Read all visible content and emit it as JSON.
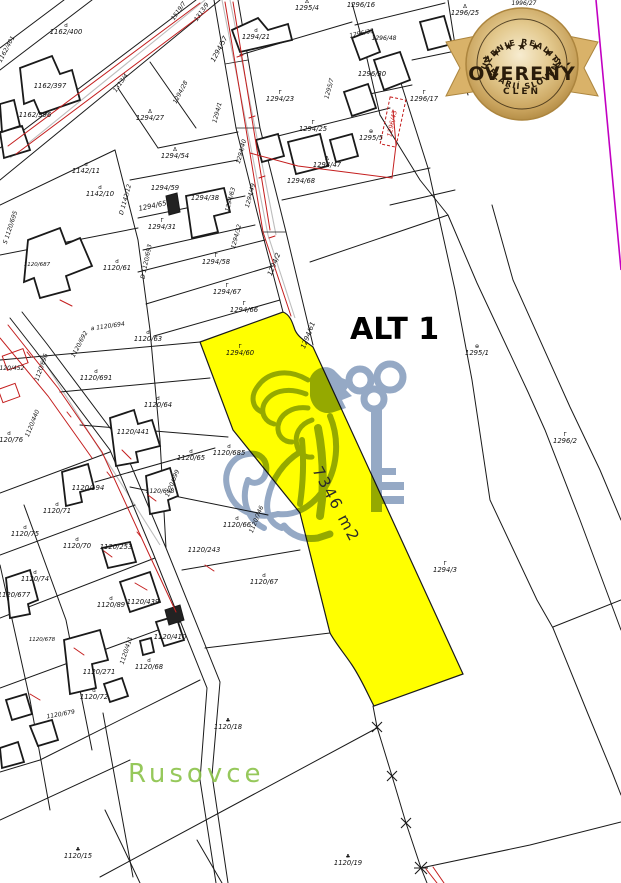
{
  "colors": {
    "highlight": "#FFFF00",
    "watermark": "#8AA0BF",
    "red": "#C41E1E",
    "line": "#1A1A1A",
    "magenta": "#C200C2",
    "green": "#8BC34A",
    "gold1": "#F7ECD0",
    "gold2": "#E3C98E",
    "gold3": "#C8A25C",
    "gold4": "#AC853E",
    "ribbon": "#D9B269",
    "badge_text": "#2A1C0A"
  },
  "map": {
    "alt_label": "ALT 1",
    "area_label": "7346 m2",
    "place_label": "Rusovce",
    "highlight_parcel_number": "1294/60",
    "labels": [
      {
        "t": "1162/400",
        "x": 66,
        "y": 34,
        "sym": "d"
      },
      {
        "t": "1162/401",
        "x": 8,
        "y": 50,
        "r": -62,
        "s": 6
      },
      {
        "t": "1162/397",
        "x": 50,
        "y": 88
      },
      {
        "t": "1162/396",
        "x": 35,
        "y": 117
      },
      {
        "t": "1313/4",
        "x": 122,
        "y": 84,
        "r": -55,
        "s": 6
      },
      {
        "t": "1294/28",
        "x": 182,
        "y": 93,
        "r": -62,
        "s": 6
      },
      {
        "t": "1294/27",
        "x": 150,
        "y": 120,
        "sym": "Δ"
      },
      {
        "t": "1519/7",
        "x": 180,
        "y": 12,
        "r": -55,
        "s": 6
      },
      {
        "t": "1313/9",
        "x": 203,
        "y": 13,
        "r": -55,
        "s": 6
      },
      {
        "t": "1294/57",
        "x": 221,
        "y": 50,
        "r": -62
      },
      {
        "t": "1294/21",
        "x": 256,
        "y": 39,
        "sym": "d"
      },
      {
        "t": "1295/4",
        "x": 307,
        "y": 10,
        "sym": "Δ"
      },
      {
        "t": "1296/16",
        "x": 361,
        "y": 7
      },
      {
        "t": "1296/33",
        "x": 362,
        "y": 35,
        "r": -12,
        "s": 6
      },
      {
        "t": "1296/48",
        "x": 384,
        "y": 40,
        "s": 6
      },
      {
        "t": "1296/30",
        "x": 372,
        "y": 76
      },
      {
        "t": "1295/7",
        "x": 331,
        "y": 89,
        "r": -75,
        "s": 6
      },
      {
        "t": "1294/23",
        "x": 280,
        "y": 101,
        "sym": "Γ"
      },
      {
        "t": "1296/17",
        "x": 424,
        "y": 101,
        "sym": "Γ"
      },
      {
        "t": "1296/25",
        "x": 465,
        "y": 15,
        "sym": "Δ"
      },
      {
        "t": "1996/27",
        "x": 524,
        "y": 5,
        "s": 6
      },
      {
        "t": "1294/25",
        "x": 313,
        "y": 131,
        "sym": "Γ"
      },
      {
        "t": "1295/5",
        "x": 371,
        "y": 140,
        "sym": "⊕"
      },
      {
        "t": "1296/43",
        "x": 394,
        "y": 124,
        "r": -78,
        "c": "#C41E1E",
        "s": 6.5
      },
      {
        "t": "1294/54",
        "x": 175,
        "y": 158,
        "sym": "Δ"
      },
      {
        "t": "1294/47",
        "x": 327,
        "y": 167,
        "sym": "Δ"
      },
      {
        "t": "1294/68",
        "x": 301,
        "y": 183
      },
      {
        "t": "1294/59",
        "x": 165,
        "y": 190
      },
      {
        "t": "1294/65",
        "x": 153,
        "y": 208,
        "r": -12
      },
      {
        "t": "1294/38",
        "x": 205,
        "y": 200
      },
      {
        "t": "1294/31",
        "x": 162,
        "y": 229,
        "sym": "Γ"
      },
      {
        "t": "1294/1",
        "x": 219,
        "y": 113,
        "r": -75,
        "s": 6
      },
      {
        "t": "1294/40",
        "x": 243,
        "y": 152,
        "r": -75,
        "s": 6
      },
      {
        "t": "1294/49",
        "x": 252,
        "y": 196,
        "r": -75,
        "s": 6
      },
      {
        "t": "1294/63",
        "x": 232,
        "y": 200,
        "r": -75,
        "s": 6
      },
      {
        "t": "1294/32",
        "x": 238,
        "y": 237,
        "r": -75,
        "s": 6
      },
      {
        "t": "1294/2",
        "x": 276,
        "y": 265,
        "r": -68
      },
      {
        "t": "1294/58",
        "x": 216,
        "y": 264,
        "sym": "Γ"
      },
      {
        "t": "1294/67",
        "x": 227,
        "y": 294,
        "sym": "Γ"
      },
      {
        "t": "1294/66",
        "x": 244,
        "y": 312,
        "sym": "Γ"
      },
      {
        "t": "1294/61",
        "x": 310,
        "y": 336,
        "r": -68
      },
      {
        "t": "1294/60",
        "x": 240,
        "y": 355,
        "sym": "Γ"
      },
      {
        "t": "1142/11",
        "x": 86,
        "y": 173,
        "sym": "d"
      },
      {
        "t": "1142/10",
        "x": 100,
        "y": 196,
        "sym": "d"
      },
      {
        "t": "D 1142/12",
        "x": 127,
        "y": 200,
        "r": -75,
        "s": 6
      },
      {
        "t": "S 1120/695",
        "x": 12,
        "y": 228,
        "r": -72,
        "s": 6
      },
      {
        "t": "D 1120/693",
        "x": 148,
        "y": 262,
        "r": -78,
        "s": 6
      },
      {
        "t": "1120/61",
        "x": 117,
        "y": 270,
        "sym": "d"
      },
      {
        "t": "1120/687",
        "x": 37,
        "y": 266,
        "s": 5.5
      },
      {
        "t": "a 1120/694",
        "x": 108,
        "y": 328,
        "r": -8,
        "s": 6
      },
      {
        "t": "1120/692",
        "x": 81,
        "y": 345,
        "r": -62,
        "s": 6
      },
      {
        "t": "1120/63",
        "x": 148,
        "y": 341,
        "sym": "d"
      },
      {
        "t": "1120/452",
        "x": 10,
        "y": 370,
        "s": 6
      },
      {
        "t": "1120/696",
        "x": 43,
        "y": 368,
        "r": -70,
        "s": 6
      },
      {
        "t": "1120/691",
        "x": 96,
        "y": 380,
        "sym": "d"
      },
      {
        "t": "1120/64",
        "x": 158,
        "y": 407,
        "sym": "d"
      },
      {
        "t": "1120/441",
        "x": 133,
        "y": 434
      },
      {
        "t": "1120/440",
        "x": 34,
        "y": 424,
        "r": -68,
        "s": 6
      },
      {
        "t": "1120/76",
        "x": 9,
        "y": 442,
        "sym": "d"
      },
      {
        "t": "1120/194",
        "x": 88,
        "y": 490
      },
      {
        "t": "1120/699",
        "x": 174,
        "y": 484,
        "r": -68,
        "s": 6
      },
      {
        "t": "1120/698",
        "x": 160,
        "y": 493,
        "s": 6
      },
      {
        "t": "1120/65",
        "x": 191,
        "y": 460,
        "sym": "d"
      },
      {
        "t": "1120/685",
        "x": 229,
        "y": 455,
        "sym": "d"
      },
      {
        "t": "1120/746",
        "x": 258,
        "y": 520,
        "r": -68,
        "s": 6
      },
      {
        "t": "1120/66",
        "x": 237,
        "y": 527,
        "sym": "d"
      },
      {
        "t": "1120/243",
        "x": 204,
        "y": 552
      },
      {
        "t": "1120/67",
        "x": 264,
        "y": 584,
        "sym": "d"
      },
      {
        "t": "1120/71",
        "x": 57,
        "y": 513,
        "sym": "d"
      },
      {
        "t": "1120/75",
        "x": 25,
        "y": 536,
        "sym": "d"
      },
      {
        "t": "1120/70",
        "x": 77,
        "y": 548,
        "sym": "d"
      },
      {
        "t": "1120/253",
        "x": 116,
        "y": 549
      },
      {
        "t": "1120/74",
        "x": 35,
        "y": 581,
        "sym": "d"
      },
      {
        "t": "1120/677",
        "x": 14,
        "y": 597
      },
      {
        "t": "1120/89",
        "x": 111,
        "y": 607,
        "sym": "d"
      },
      {
        "t": "1120/439",
        "x": 143,
        "y": 604
      },
      {
        "t": "1120/410",
        "x": 170,
        "y": 639
      },
      {
        "t": "1120/411",
        "x": 128,
        "y": 651,
        "r": -72,
        "s": 6
      },
      {
        "t": "1120/68",
        "x": 149,
        "y": 669,
        "sym": "d"
      },
      {
        "t": "1120/271",
        "x": 99,
        "y": 674
      },
      {
        "t": "1120/72",
        "x": 94,
        "y": 699,
        "sym": "d"
      },
      {
        "t": "1120/678",
        "x": 42,
        "y": 641,
        "s": 5.5
      },
      {
        "t": "1120/679",
        "x": 61,
        "y": 716,
        "r": -10,
        "s": 6
      },
      {
        "t": "1120/18",
        "x": 228,
        "y": 729,
        "sym": "♣"
      },
      {
        "t": "1120/19",
        "x": 348,
        "y": 865,
        "sym": "♣"
      },
      {
        "t": "1120/15",
        "x": 78,
        "y": 858,
        "sym": "♣"
      },
      {
        "t": "1294/3",
        "x": 445,
        "y": 572,
        "sym": "Γ"
      },
      {
        "t": "1295/1",
        "x": 477,
        "y": 355,
        "sym": "⊕"
      },
      {
        "t": "1296/2",
        "x": 565,
        "y": 443,
        "sym": "Γ"
      }
    ]
  },
  "badge": {
    "top_text": "ZDRUŽENIE REALITNÝCH",
    "bottom_text": "KANCELÁRIÍ SLOVENSKA",
    "main_text": "OVERENÝ",
    "sub_text": "ČLEN",
    "stars": "★ ★ ★",
    "star_left": "★",
    "star_right": "★"
  }
}
